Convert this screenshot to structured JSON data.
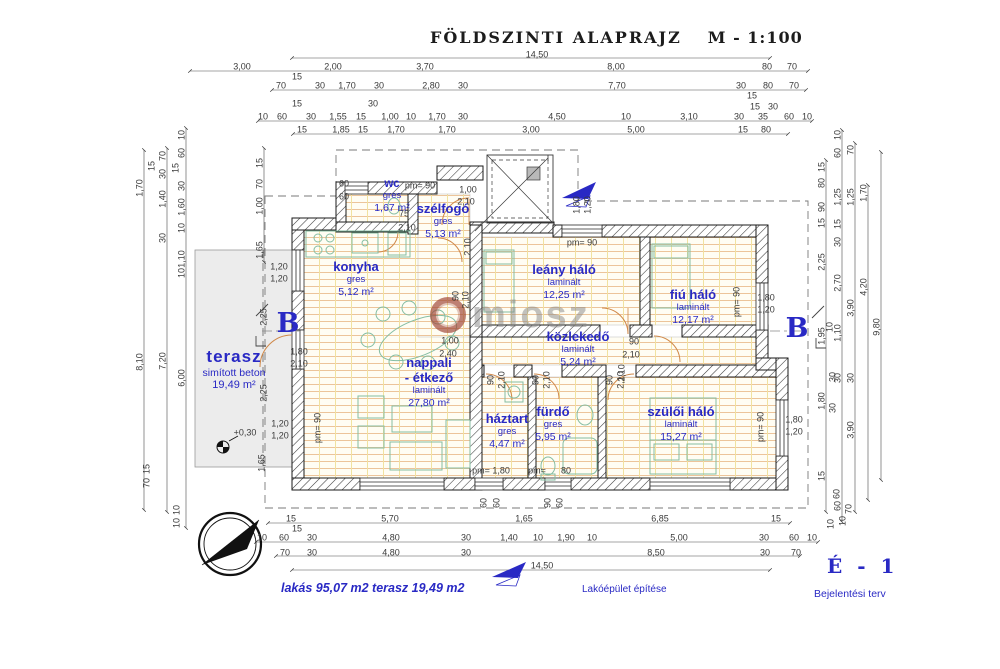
{
  "title": {
    "main": "FÖLDSZINTI ALAPRAJZ",
    "scale": "M - 1:100"
  },
  "colors": {
    "label_blue": "#2929c4",
    "dim_text": "#3a3a3a",
    "wall": "#1a1a1a",
    "floor_hatch_h": "#ecc49a",
    "floor_hatch_v": "#f1e2a0",
    "terasz_fill": "#ececec",
    "furniture": "#84bda2",
    "door_arc": "#d08848",
    "watermark_gray": "#878787",
    "watermark_red": "#a04637"
  },
  "icons": {
    "north_compass": "double circle with black needle pointing north-east",
    "level_marker": "half-filled survey circle at +0,30",
    "section_arrow_top": "blue filled section arrow",
    "section_arrow_bottom": "blue filled section arrow",
    "watermark_logo": "red-brown ring logo"
  },
  "watermark": {
    "text": "miosz"
  },
  "footer": {
    "areas": "lakás  95,07 m2  terasz 19,49 m2",
    "project": "Lakóépület építése",
    "sheet": "É - 1",
    "doc_type": "Bejelentési terv"
  },
  "rooms": [
    {
      "name": "wc",
      "material": "gres",
      "area": "1,67 m²",
      "x": 392,
      "y": 178,
      "cls": "sm"
    },
    {
      "name": "szélfogó",
      "material": "gres",
      "area": "5,13 m²",
      "x": 443,
      "y": 202
    },
    {
      "name": "konyha",
      "material": "gres",
      "area": "5,12 m²",
      "x": 356,
      "y": 260
    },
    {
      "name": "terasz",
      "material": "simított beton",
      "area": "19,49 m²",
      "x": 234,
      "y": 347,
      "cls": "lg"
    },
    {
      "name": "nappali",
      "name2": "- étkező",
      "material": "laminált",
      "area": "27,80 m²",
      "x": 429,
      "y": 356
    },
    {
      "name": "leány háló",
      "material": "laminált",
      "area": "12,25 m²",
      "x": 564,
      "y": 263
    },
    {
      "name": "fiú háló",
      "material": "laminált",
      "area": "12,17 m²",
      "x": 693,
      "y": 288
    },
    {
      "name": "közlekedő",
      "material": "laminált",
      "area": "5,24 m²",
      "x": 578,
      "y": 330
    },
    {
      "name": "háztart",
      "material": "gres",
      "area": "4,47 m²",
      "x": 507,
      "y": 412
    },
    {
      "name": "fürdő",
      "material": "gres",
      "area": "5,95 m²",
      "x": 553,
      "y": 405
    },
    {
      "name": "szülői háló",
      "material": "laminált",
      "area": "15,27 m²",
      "x": 681,
      "y": 405
    }
  ],
  "section_markers": [
    {
      "label": "B",
      "x": 288,
      "y": 310
    },
    {
      "label": "B",
      "x": 797,
      "y": 315
    }
  ],
  "dims_h": [
    {
      "t": "14,50",
      "x": 537,
      "y": 55
    },
    {
      "t": "3,00",
      "x": 242,
      "y": 67
    },
    {
      "t": "2,00",
      "x": 333,
      "y": 67
    },
    {
      "t": "3,70",
      "x": 425,
      "y": 67
    },
    {
      "t": "8,00",
      "x": 616,
      "y": 67
    },
    {
      "t": "80",
      "x": 767,
      "y": 67
    },
    {
      "t": "70",
      "x": 792,
      "y": 67
    },
    {
      "t": "15",
      "x": 297,
      "y": 77
    },
    {
      "t": "70",
      "x": 281,
      "y": 86
    },
    {
      "t": "30",
      "x": 320,
      "y": 86
    },
    {
      "t": "1,70",
      "x": 347,
      "y": 86
    },
    {
      "t": "30",
      "x": 379,
      "y": 86
    },
    {
      "t": "2,80",
      "x": 431,
      "y": 86
    },
    {
      "t": "30",
      "x": 463,
      "y": 86
    },
    {
      "t": "7,70",
      "x": 617,
      "y": 86
    },
    {
      "t": "30",
      "x": 741,
      "y": 86
    },
    {
      "t": "80",
      "x": 768,
      "y": 86
    },
    {
      "t": "70",
      "x": 794,
      "y": 86
    },
    {
      "t": "15",
      "x": 752,
      "y": 96
    },
    {
      "t": "15",
      "x": 297,
      "y": 104
    },
    {
      "t": "30",
      "x": 373,
      "y": 104
    },
    {
      "t": "15",
      "x": 755,
      "y": 107
    },
    {
      "t": "30",
      "x": 773,
      "y": 107
    },
    {
      "t": "10",
      "x": 263,
      "y": 117
    },
    {
      "t": "60",
      "x": 282,
      "y": 117
    },
    {
      "t": "30",
      "x": 311,
      "y": 117
    },
    {
      "t": "1,55",
      "x": 338,
      "y": 117
    },
    {
      "t": "15",
      "x": 361,
      "y": 117
    },
    {
      "t": "1,00",
      "x": 390,
      "y": 117
    },
    {
      "t": "10",
      "x": 411,
      "y": 117
    },
    {
      "t": "1,70",
      "x": 437,
      "y": 117
    },
    {
      "t": "30",
      "x": 463,
      "y": 117
    },
    {
      "t": "4,50",
      "x": 557,
      "y": 117
    },
    {
      "t": "10",
      "x": 626,
      "y": 117
    },
    {
      "t": "3,10",
      "x": 689,
      "y": 117
    },
    {
      "t": "30",
      "x": 739,
      "y": 117
    },
    {
      "t": "35",
      "x": 763,
      "y": 117
    },
    {
      "t": "60",
      "x": 789,
      "y": 117
    },
    {
      "t": "10",
      "x": 807,
      "y": 117
    },
    {
      "t": "15",
      "x": 302,
      "y": 130
    },
    {
      "t": "1,85",
      "x": 341,
      "y": 130
    },
    {
      "t": "15",
      "x": 363,
      "y": 130
    },
    {
      "t": "1,70",
      "x": 396,
      "y": 130
    },
    {
      "t": "1,70",
      "x": 447,
      "y": 130
    },
    {
      "t": "3,00",
      "x": 531,
      "y": 130
    },
    {
      "t": "5,00",
      "x": 636,
      "y": 130
    },
    {
      "t": "15",
      "x": 743,
      "y": 130
    },
    {
      "t": "80",
      "x": 766,
      "y": 130
    },
    {
      "t": "60",
      "x": 344,
      "y": 184
    },
    {
      "t": "60",
      "x": 344,
      "y": 197
    },
    {
      "t": "pm= 90",
      "x": 420,
      "y": 186
    },
    {
      "t": "75",
      "x": 404,
      "y": 214
    },
    {
      "t": "2,10",
      "x": 407,
      "y": 228
    },
    {
      "t": "1,00",
      "x": 468,
      "y": 190
    },
    {
      "t": "2,10",
      "x": 466,
      "y": 202
    },
    {
      "t": "pm= 90",
      "x": 582,
      "y": 243
    },
    {
      "t": "1,00",
      "x": 450,
      "y": 341
    },
    {
      "t": "2,40",
      "x": 448,
      "y": 354
    },
    {
      "t": "1,80",
      "x": 299,
      "y": 352
    },
    {
      "t": "2,10",
      "x": 299,
      "y": 364
    },
    {
      "t": "1,20",
      "x": 279,
      "y": 267
    },
    {
      "t": "1,20",
      "x": 279,
      "y": 279
    },
    {
      "t": "+0,30",
      "x": 245,
      "y": 433
    },
    {
      "t": "1,20",
      "x": 280,
      "y": 424
    },
    {
      "t": "1,20",
      "x": 280,
      "y": 436
    },
    {
      "t": "90",
      "x": 634,
      "y": 342
    },
    {
      "t": "2,10",
      "x": 631,
      "y": 355
    },
    {
      "t": "1,80",
      "x": 766,
      "y": 298
    },
    {
      "t": "1,20",
      "x": 766,
      "y": 310
    },
    {
      "t": "1,80",
      "x": 794,
      "y": 420
    },
    {
      "t": "1,20",
      "x": 794,
      "y": 432
    },
    {
      "t": "pm= 1,80",
      "x": 491,
      "y": 471
    },
    {
      "t": "pm=",
      "x": 537,
      "y": 471
    },
    {
      "t": "80",
      "x": 566,
      "y": 471
    },
    {
      "t": "15",
      "x": 291,
      "y": 519
    },
    {
      "t": "5,70",
      "x": 390,
      "y": 519
    },
    {
      "t": "1,65",
      "x": 524,
      "y": 519
    },
    {
      "t": "6,85",
      "x": 660,
      "y": 519
    },
    {
      "t": "15",
      "x": 776,
      "y": 519
    },
    {
      "t": "15",
      "x": 297,
      "y": 529
    },
    {
      "t": "10",
      "x": 262,
      "y": 538
    },
    {
      "t": "60",
      "x": 284,
      "y": 538
    },
    {
      "t": "30",
      "x": 312,
      "y": 538
    },
    {
      "t": "4,80",
      "x": 391,
      "y": 538
    },
    {
      "t": "30",
      "x": 466,
      "y": 538
    },
    {
      "t": "1,40",
      "x": 509,
      "y": 538
    },
    {
      "t": "10",
      "x": 538,
      "y": 538
    },
    {
      "t": "1,90",
      "x": 566,
      "y": 538
    },
    {
      "t": "10",
      "x": 592,
      "y": 538
    },
    {
      "t": "5,00",
      "x": 679,
      "y": 538
    },
    {
      "t": "30",
      "x": 764,
      "y": 538
    },
    {
      "t": "60",
      "x": 794,
      "y": 538
    },
    {
      "t": "10",
      "x": 812,
      "y": 538
    },
    {
      "t": "70",
      "x": 285,
      "y": 553
    },
    {
      "t": "30",
      "x": 312,
      "y": 553
    },
    {
      "t": "4,80",
      "x": 391,
      "y": 553
    },
    {
      "t": "30",
      "x": 466,
      "y": 553
    },
    {
      "t": "8,50",
      "x": 656,
      "y": 553
    },
    {
      "t": "30",
      "x": 765,
      "y": 553
    },
    {
      "t": "70",
      "x": 796,
      "y": 553
    },
    {
      "t": "14,50",
      "x": 542,
      "y": 566
    }
  ],
  "dims_v": [
    {
      "t": "1,70",
      "x": 140,
      "y": 188
    },
    {
      "t": "8,10",
      "x": 140,
      "y": 362
    },
    {
      "t": "70",
      "x": 163,
      "y": 156
    },
    {
      "t": "15",
      "x": 152,
      "y": 166
    },
    {
      "t": "30",
      "x": 163,
      "y": 174
    },
    {
      "t": "1,40",
      "x": 163,
      "y": 199
    },
    {
      "t": "30",
      "x": 163,
      "y": 238
    },
    {
      "t": "7,20",
      "x": 163,
      "y": 361
    },
    {
      "t": "10",
      "x": 182,
      "y": 135
    },
    {
      "t": "60",
      "x": 182,
      "y": 153
    },
    {
      "t": "15",
      "x": 176,
      "y": 168
    },
    {
      "t": "30",
      "x": 182,
      "y": 186
    },
    {
      "t": "1,60",
      "x": 182,
      "y": 207
    },
    {
      "t": "10",
      "x": 182,
      "y": 228
    },
    {
      "t": "1,10",
      "x": 182,
      "y": 259
    },
    {
      "t": "10",
      "x": 182,
      "y": 273
    },
    {
      "t": "6,00",
      "x": 182,
      "y": 378
    },
    {
      "t": "15",
      "x": 260,
      "y": 163
    },
    {
      "t": "70",
      "x": 260,
      "y": 184
    },
    {
      "t": "1,00",
      "x": 260,
      "y": 206
    },
    {
      "t": "1,65",
      "x": 260,
      "y": 250
    },
    {
      "t": "2,25",
      "x": 264,
      "y": 317
    },
    {
      "t": "2,25",
      "x": 264,
      "y": 393
    },
    {
      "t": "1,65",
      "x": 262,
      "y": 463
    },
    {
      "t": "15",
      "x": 147,
      "y": 469
    },
    {
      "t": "70",
      "x": 147,
      "y": 483
    },
    {
      "t": "10",
      "x": 177,
      "y": 510
    },
    {
      "t": "10",
      "x": 177,
      "y": 523
    },
    {
      "t": "90",
      "x": 456,
      "y": 296
    },
    {
      "t": "2,10",
      "x": 466,
      "y": 300
    },
    {
      "t": "2,10",
      "x": 468,
      "y": 247
    },
    {
      "t": "1,80",
      "x": 577,
      "y": 205
    },
    {
      "t": "1,20",
      "x": 588,
      "y": 205
    },
    {
      "t": "pm= 90",
      "x": 737,
      "y": 302
    },
    {
      "t": "2,10",
      "x": 622,
      "y": 373
    },
    {
      "t": "90",
      "x": 491,
      "y": 380
    },
    {
      "t": "2,10",
      "x": 502,
      "y": 380
    },
    {
      "t": "90",
      "x": 536,
      "y": 380
    },
    {
      "t": "2,10",
      "x": 547,
      "y": 380
    },
    {
      "t": "90",
      "x": 610,
      "y": 380
    },
    {
      "t": "2,10",
      "x": 621,
      "y": 380
    },
    {
      "t": "pm= 90",
      "x": 318,
      "y": 428
    },
    {
      "t": "pm= 90",
      "x": 761,
      "y": 427
    },
    {
      "t": "60",
      "x": 484,
      "y": 503
    },
    {
      "t": "60",
      "x": 497,
      "y": 503
    },
    {
      "t": "90",
      "x": 548,
      "y": 503
    },
    {
      "t": "60",
      "x": 560,
      "y": 503
    },
    {
      "t": "15",
      "x": 822,
      "y": 167
    },
    {
      "t": "80",
      "x": 822,
      "y": 183
    },
    {
      "t": "90",
      "x": 822,
      "y": 207
    },
    {
      "t": "15",
      "x": 822,
      "y": 223
    },
    {
      "t": "2,25",
      "x": 822,
      "y": 262
    },
    {
      "t": "10",
      "x": 830,
      "y": 327
    },
    {
      "t": "1,95",
      "x": 822,
      "y": 336
    },
    {
      "t": "30",
      "x": 833,
      "y": 377
    },
    {
      "t": "1,80",
      "x": 822,
      "y": 401
    },
    {
      "t": "10",
      "x": 838,
      "y": 135
    },
    {
      "t": "60",
      "x": 838,
      "y": 153
    },
    {
      "t": "1,25",
      "x": 838,
      "y": 197
    },
    {
      "t": "15",
      "x": 838,
      "y": 224
    },
    {
      "t": "30",
      "x": 838,
      "y": 242
    },
    {
      "t": "2,70",
      "x": 838,
      "y": 283
    },
    {
      "t": "1,10",
      "x": 838,
      "y": 333
    },
    {
      "t": "30",
      "x": 838,
      "y": 378
    },
    {
      "t": "70",
      "x": 851,
      "y": 150
    },
    {
      "t": "1,25",
      "x": 851,
      "y": 197
    },
    {
      "t": "3,90",
      "x": 851,
      "y": 308
    },
    {
      "t": "30",
      "x": 851,
      "y": 378
    },
    {
      "t": "1,70",
      "x": 864,
      "y": 193
    },
    {
      "t": "4,20",
      "x": 864,
      "y": 287
    },
    {
      "t": "9,80",
      "x": 877,
      "y": 327
    },
    {
      "t": "30",
      "x": 833,
      "y": 408
    },
    {
      "t": "3,90",
      "x": 851,
      "y": 430
    },
    {
      "t": "15",
      "x": 822,
      "y": 476
    },
    {
      "t": "60",
      "x": 837,
      "y": 494
    },
    {
      "t": "10",
      "x": 831,
      "y": 524
    },
    {
      "t": "60",
      "x": 838,
      "y": 506
    },
    {
      "t": "70",
      "x": 849,
      "y": 509
    },
    {
      "t": "10",
      "x": 843,
      "y": 521
    }
  ]
}
